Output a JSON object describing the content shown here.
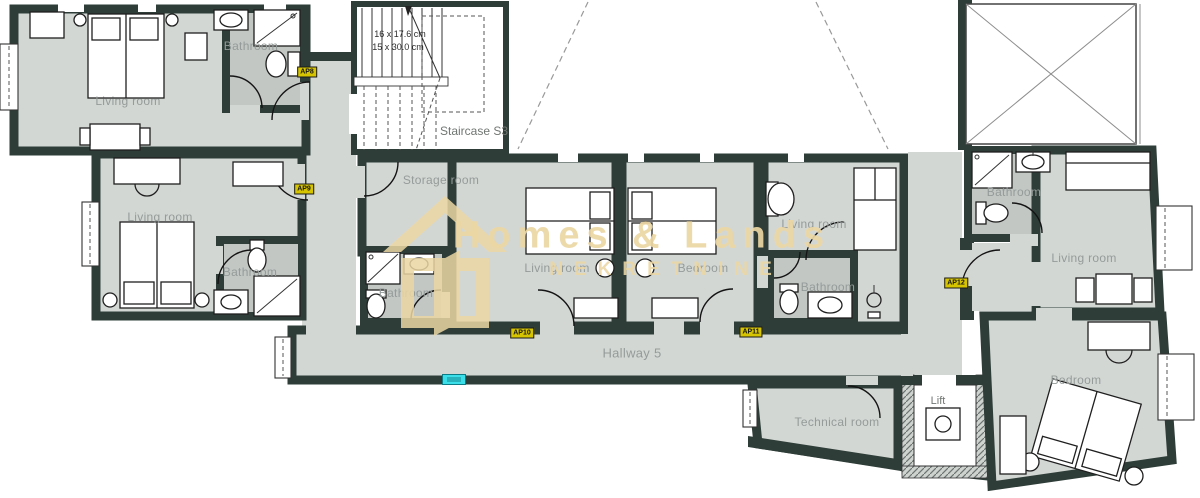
{
  "watermark": {
    "title": "Homes & Lands",
    "subtitle": "NEKRETNINE"
  },
  "staircase": {
    "dim_line1": "16 x 17.6 cm",
    "dim_line2": "15 x 30.0 cm",
    "label": "Staircase S3"
  },
  "rooms": {
    "ap8_living": "Living room",
    "ap8_bath": "Bathroom",
    "ap9_living": "Living room",
    "ap9_bath": "Bathroom",
    "storage": "Storage room",
    "ap10_bath": "Bathroom",
    "ap10_living": "Living room",
    "ap11_bedroom": "Bedroom",
    "ap11_living": "Living room",
    "ap11_bath": "Bathroom",
    "hallway": "Hallway 5",
    "technical": "Technical room",
    "lift": "Lift",
    "ap12_bath": "Bathroom",
    "ap12_living": "Living room",
    "ap12_bedroom": "Bedroom"
  },
  "badges": {
    "ap8": "AP8",
    "ap9": "AP9",
    "ap10": "AP10",
    "ap11": "AP11",
    "ap12": "AP12"
  },
  "colors": {
    "wall": "#2e3d38",
    "floor": "#d3d7d4",
    "bath_floor": "#c2c7c4",
    "label": "#949b99",
    "badge_bg": "#d6c400",
    "watermark": "#ecd7a4",
    "marker": "#3bdfe9"
  }
}
